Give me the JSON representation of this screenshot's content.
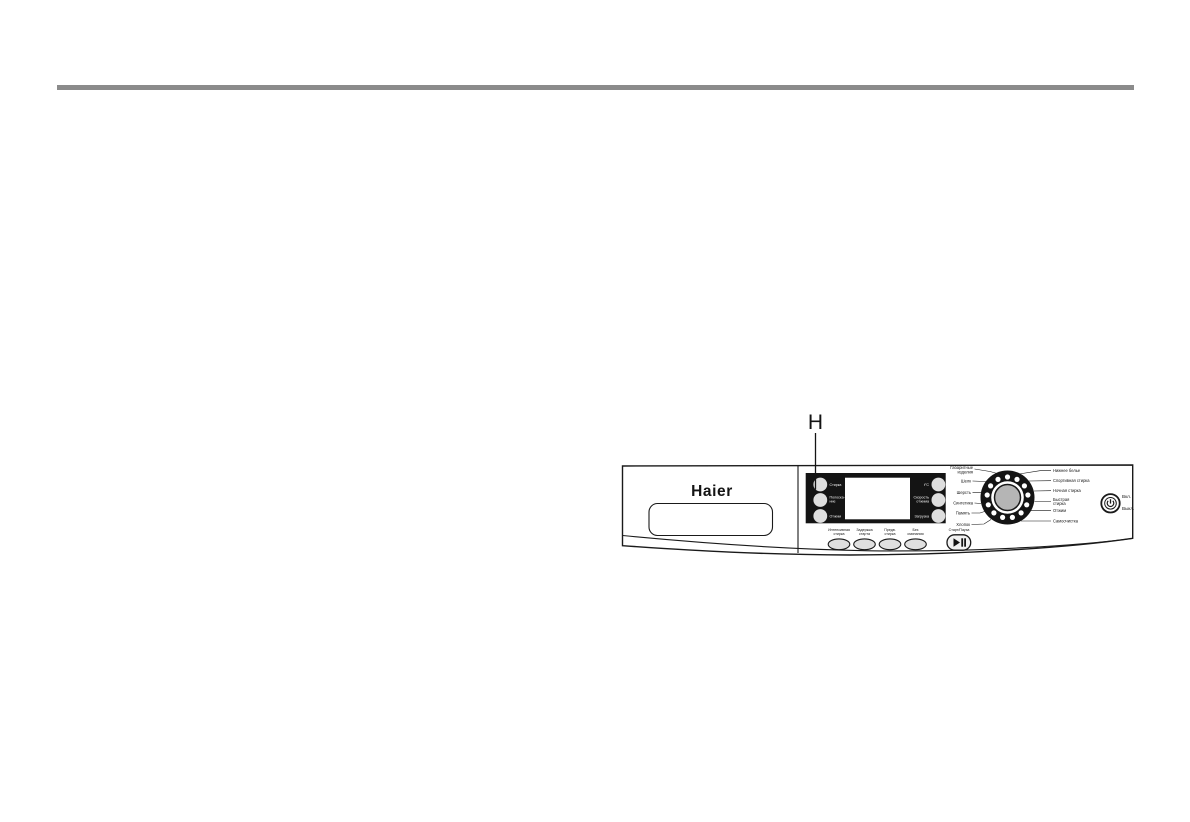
{
  "page": {
    "pointer_label": "H"
  },
  "panel": {
    "brand": "Haier",
    "display": {
      "left_indicators": [
        {
          "line1": "Стирка",
          "line2": ""
        },
        {
          "line1": "Полоска-",
          "line2": "ние"
        },
        {
          "line1": "Отжим",
          "line2": ""
        }
      ],
      "right_indicators": [
        {
          "line1": "t°C",
          "line2": ""
        },
        {
          "line1": "Скорость",
          "line2": "отжима"
        },
        {
          "line1": "Загрузка",
          "line2": ""
        }
      ]
    },
    "option_buttons": [
      {
        "line1": "Интенсивная",
        "line2": "стирка"
      },
      {
        "line1": "Задержка",
        "line2": "старта"
      },
      {
        "line1": "Предв.",
        "line2": "стирка"
      },
      {
        "line1": "Без",
        "line2": "сминания"
      }
    ],
    "start_pause": {
      "label": "Старт/Пауза"
    },
    "program_dial": {
      "left_programs": [
        {
          "line1": "Габаритные",
          "line2": "изделия"
        },
        {
          "line1": "Шелк",
          "line2": ""
        },
        {
          "line1": "Шерсть",
          "line2": ""
        },
        {
          "line1": "Синтетика",
          "line2": ""
        },
        {
          "line1": "Память",
          "line2": ""
        },
        {
          "line1": "Хлопок",
          "line2": ""
        }
      ],
      "right_programs": [
        {
          "line1": "Нижнее белье",
          "line2": ""
        },
        {
          "line1": "Спортивная стирка",
          "line2": ""
        },
        {
          "line1": "Ночная стирка",
          "line2": ""
        },
        {
          "line1": "Быстрая",
          "line2": "стирка"
        },
        {
          "line1": "Отжим",
          "line2": ""
        },
        {
          "line1": "Самоочистка",
          "line2": ""
        }
      ]
    },
    "power": {
      "on_label": "Вкл.",
      "off_label": "Выкл."
    }
  },
  "colors": {
    "rule_gray": "#8b8b8b",
    "panel_ink": "#1a1a1a",
    "block_black": "#141414",
    "knob_gray": "#b5b5b5",
    "button_gray": "#dedede"
  }
}
